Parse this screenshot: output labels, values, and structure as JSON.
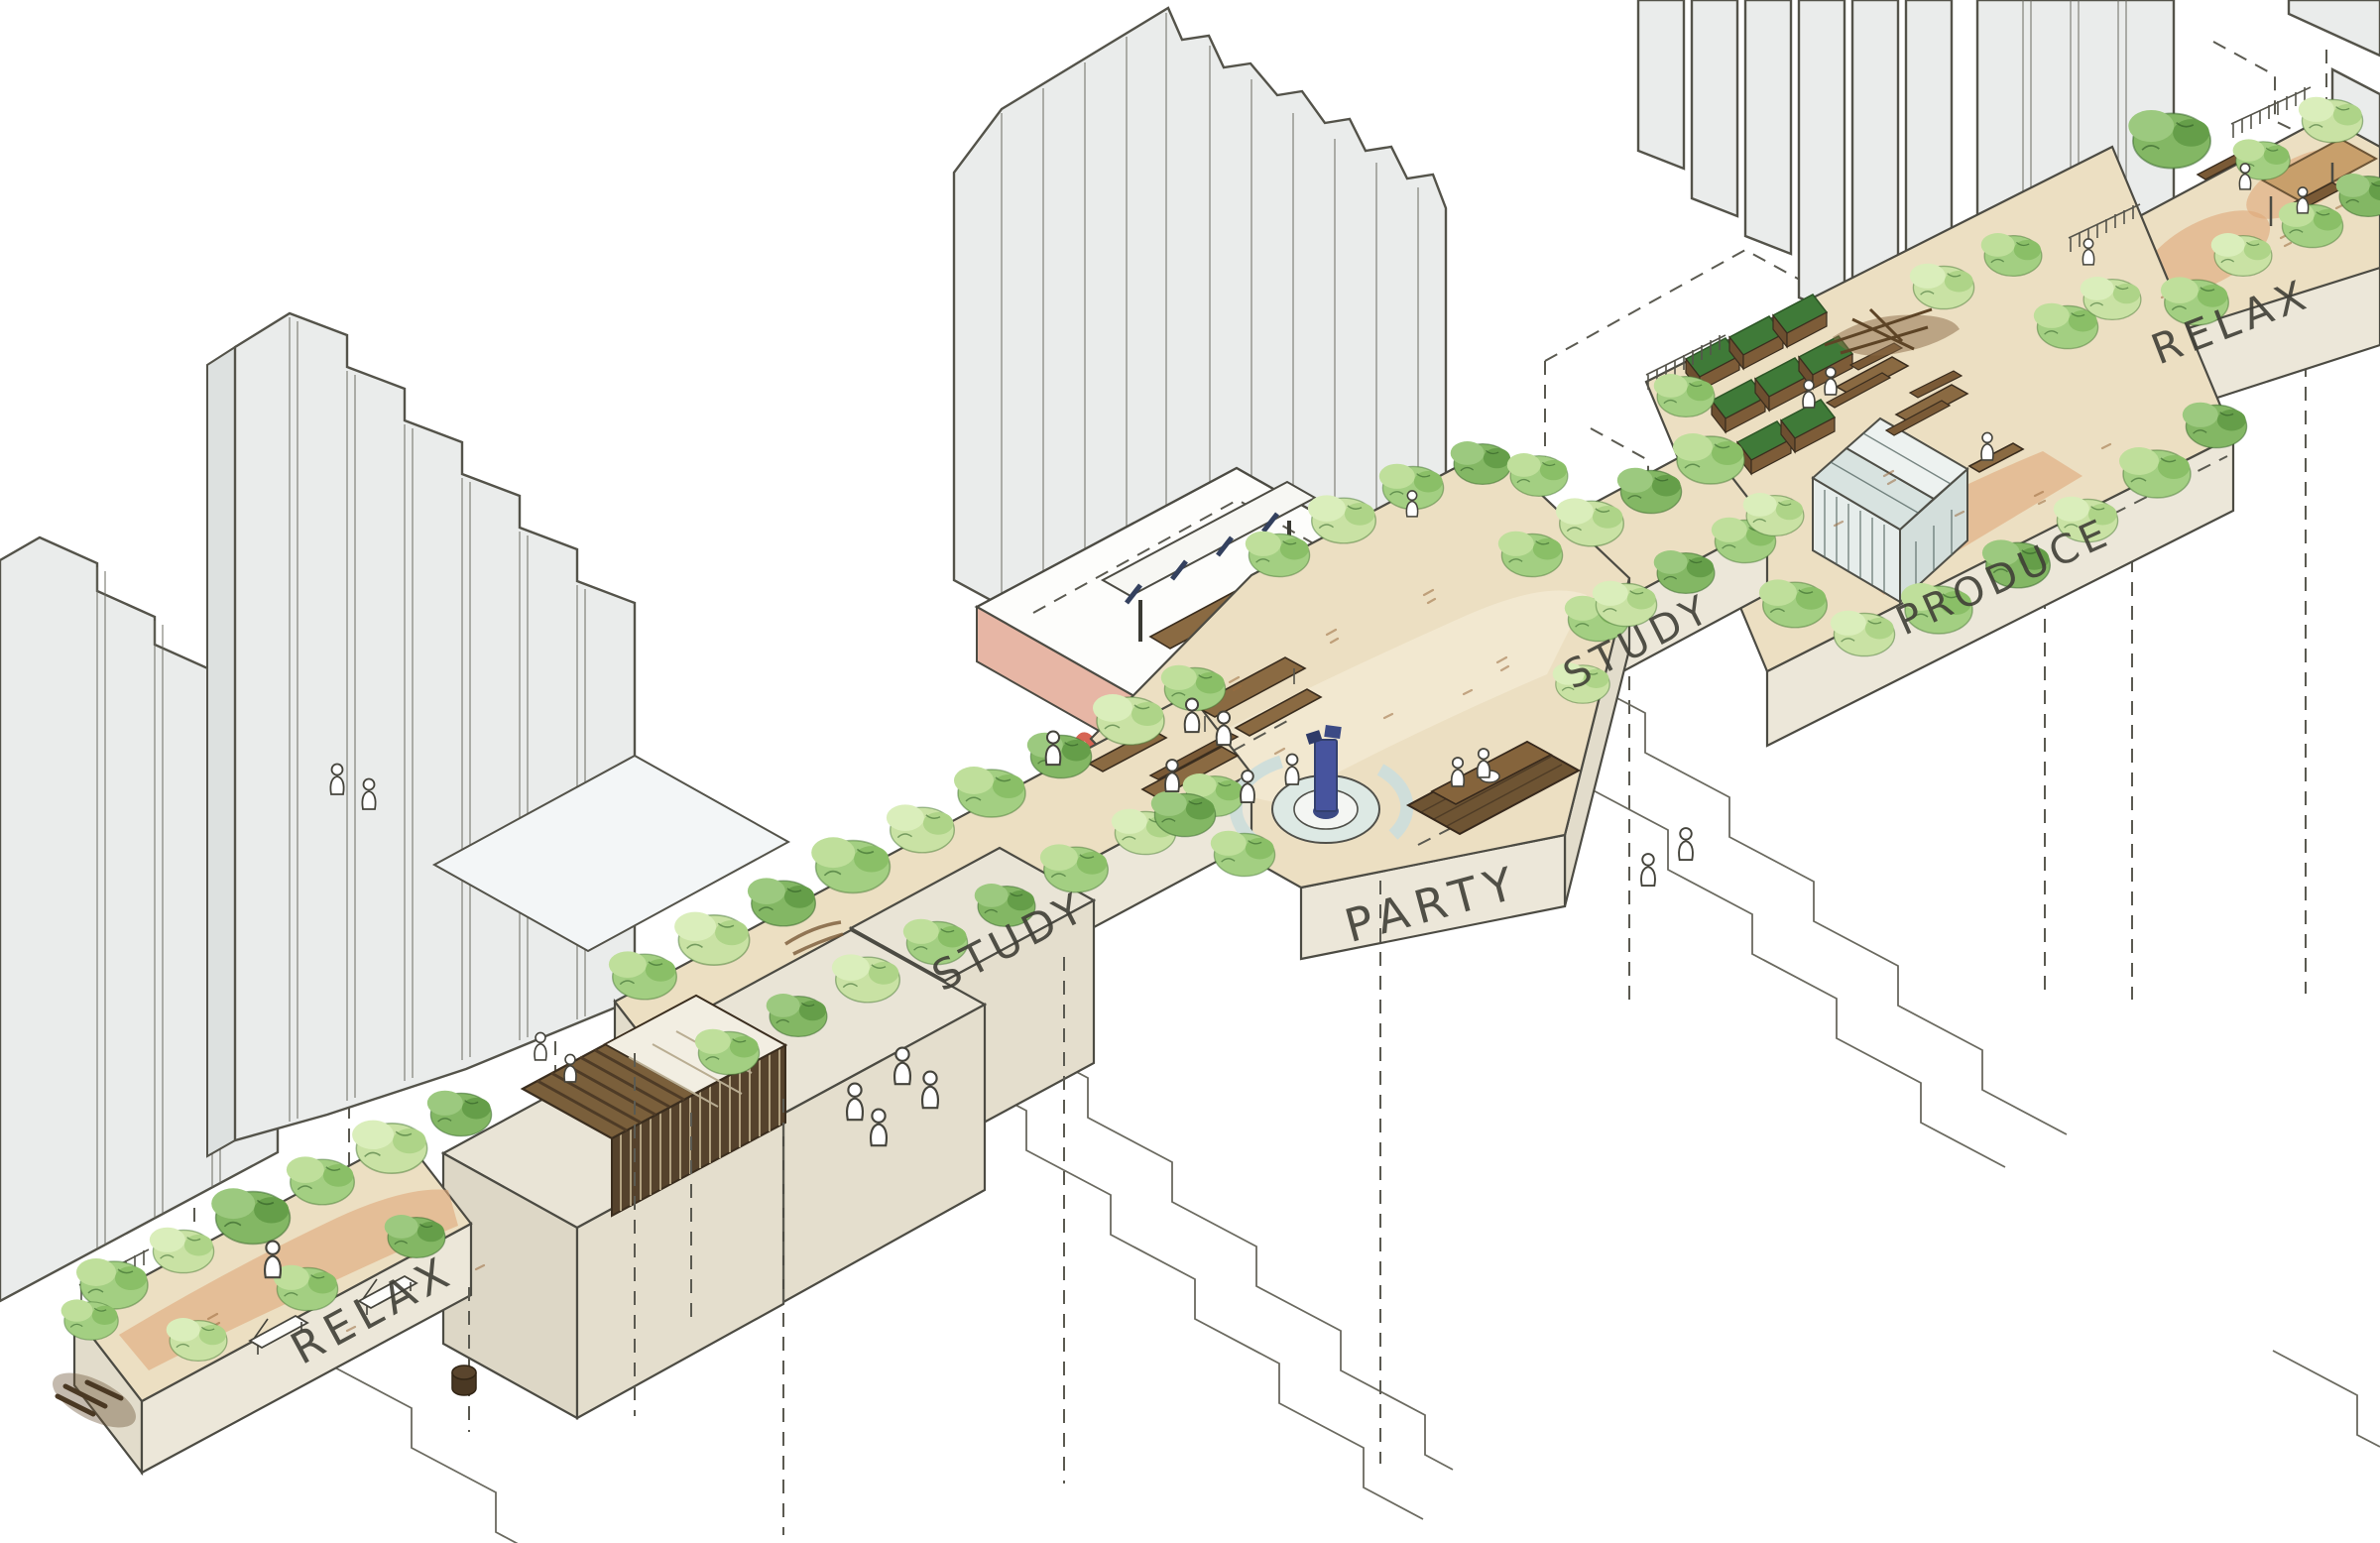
{
  "diagram": {
    "zones": [
      {
        "id": "relax-1",
        "label": "RELAX"
      },
      {
        "id": "study-1",
        "label": "STUDY"
      },
      {
        "id": "party",
        "label": "PARTY"
      },
      {
        "id": "study-2",
        "label": "STUDY"
      },
      {
        "id": "produce",
        "label": "PRODUCE"
      },
      {
        "id": "relax-2",
        "label": "RELAX"
      }
    ],
    "palette": {
      "background": "#ffffff",
      "ink": "#4c4b43",
      "building_face": "#eaeceb",
      "building_side": "#dde1e0",
      "platform_fascia": "#ece7d9",
      "ground_sand": "#ecdfc2",
      "ground_terracotta": "#dfa87a",
      "foliage_light": "#c9e2a4",
      "foliage_mid": "#a3cf82",
      "foliage_dark": "#83b764",
      "timber": "#7a5f3b",
      "stage_pink": "#e7b6a5",
      "graffiti_red": "#cf4937",
      "graffiti_blue": "#4a5fae",
      "water_column_blue": "#47549e",
      "pool_pale": "#dde9e4"
    }
  }
}
